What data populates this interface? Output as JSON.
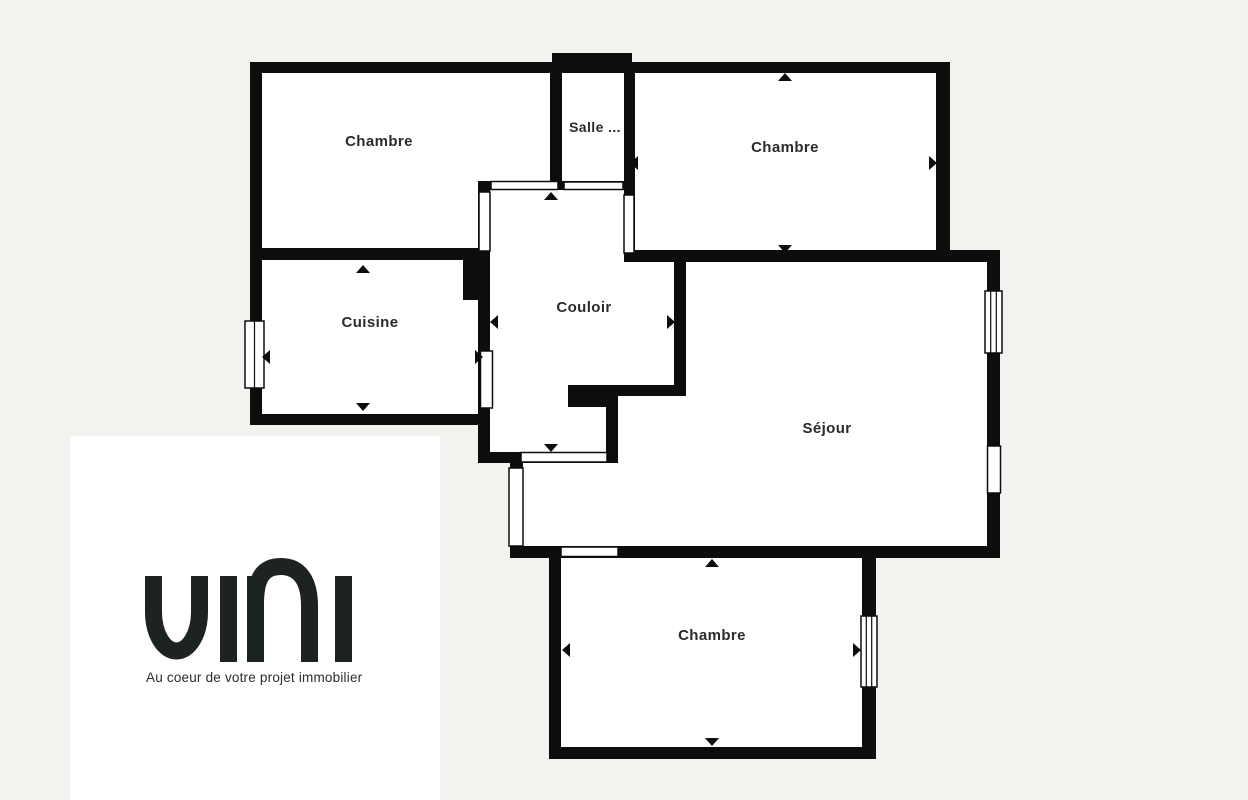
{
  "floorplan": {
    "rooms": [
      {
        "id": "chambre-top-left",
        "label": "Chambre"
      },
      {
        "id": "salle",
        "label": "Salle ..."
      },
      {
        "id": "chambre-top-right",
        "label": "Chambre"
      },
      {
        "id": "cuisine",
        "label": "Cuisine"
      },
      {
        "id": "couloir",
        "label": "Couloir"
      },
      {
        "id": "sejour",
        "label": "Séjour"
      },
      {
        "id": "chambre-bottom",
        "label": "Chambre"
      }
    ],
    "colors": {
      "background": "#f3f2ef",
      "walls": "#0d0d0d",
      "room_fill": "#ffffff",
      "label_text": "#2b2b2b"
    }
  },
  "logo": {
    "brand": "uni",
    "tagline": "Au coeur de votre projet immobilier",
    "colors": {
      "mark": "#1d2420",
      "card_background": "#ffffff"
    }
  }
}
